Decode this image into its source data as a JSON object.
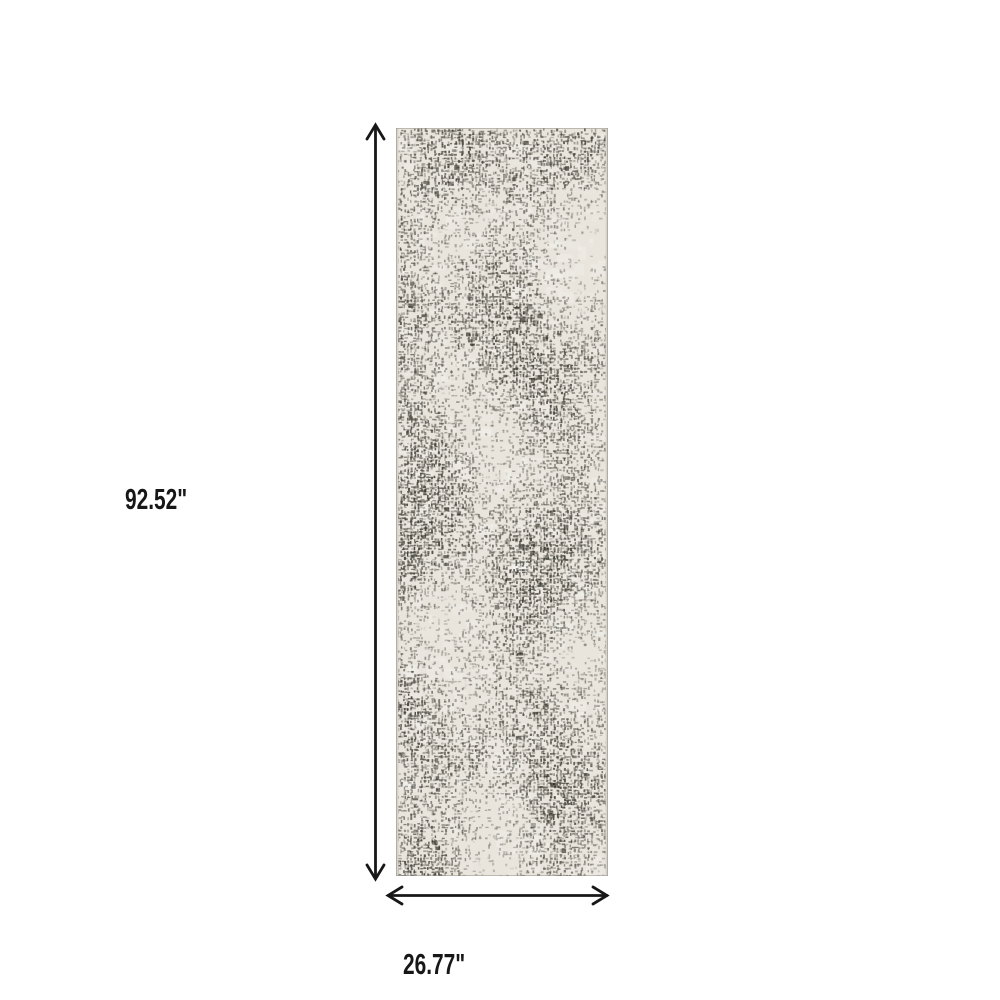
{
  "image": {
    "subject": "distressed abstract ivory and charcoal runner rug, top view product photo with dimension arrows"
  },
  "dimensions": {
    "height_label": "92.52\"",
    "width_label": "26.77\""
  },
  "colors": {
    "background": "#ffffff",
    "dimension_line": "#171717",
    "label_text": "#171717",
    "rug_base": "#e9e5dd",
    "rug_pattern_dark": "#3c3b33",
    "rug_edge": "#d6d3cb"
  }
}
